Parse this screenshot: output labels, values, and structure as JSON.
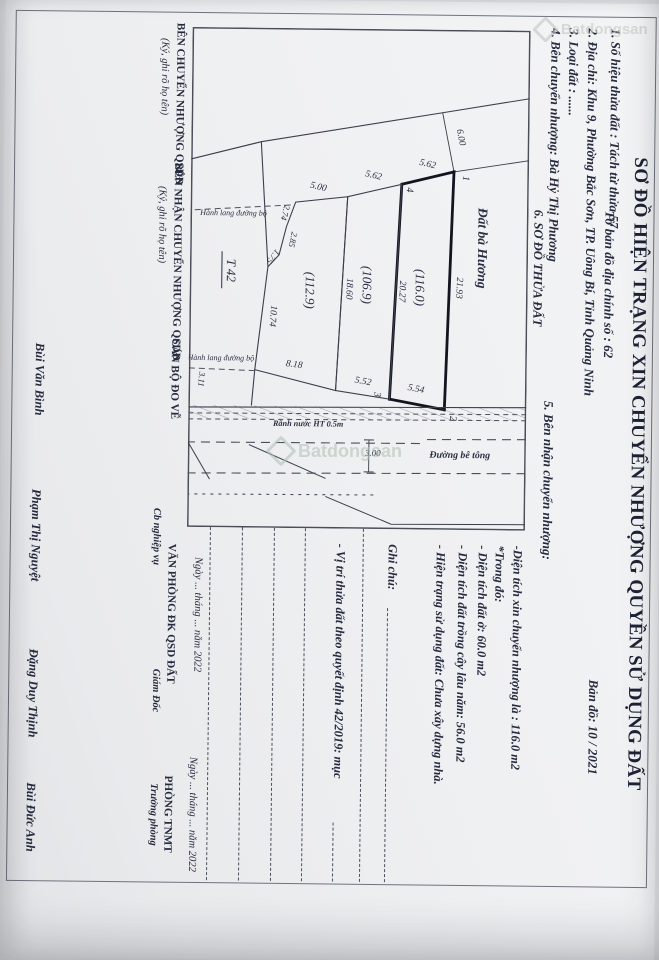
{
  "doc": {
    "title": "SƠ ĐỒ HIỆN TRẠNG XIN CHUYỂN NHƯỢNG QUYỀN SỬ DỤNG ĐẤT",
    "item1": "1. Số hiệu thửa đất : Tách từ thửa 57",
    "sheet": "Tờ bản đồ địa chính số : 62",
    "map_no": "Bản đồ:  10 / 2021",
    "item2": "2. Địa chỉ:  Khu 9, Phường Bắc Sơn, TP. Uông Bí, Tỉnh Quảng Ninh",
    "item3": "3. Loại đất  : ......",
    "item4": "4. Bên chuyển nhượng: Bà Hỷ Thị Phương",
    "item5": "5. Bên nhận chuyển nhượng:",
    "item6": "6. SƠ ĐỒ THỬA ĐẤT"
  },
  "map": {
    "neighbor": "Đất bà Hương",
    "tie_dim": "6.00",
    "v1": "1",
    "v2": "2",
    "v3": "3",
    "v4": "4",
    "p1": {
      "area": "(116.0)",
      "top": "21.93",
      "inner": "20.27",
      "left": "5.62",
      "right": "5.54"
    },
    "p2": {
      "area": "(106.9)",
      "inner": "18.60",
      "left": "5.62",
      "right": "5.52"
    },
    "p3": {
      "area": "(112.9)",
      "left": "5.00",
      "right": "8.18",
      "bottom": "10.74",
      "j1": "2.74",
      "j2": "2.85",
      "j3": "1.75",
      "extra": "3.11"
    },
    "marker": "T 42",
    "corridor": "Hành lang đường bộ",
    "ditch": "Rãnh nước HT 0.5m",
    "road": "Đường bê tông",
    "road_width": "3.00"
  },
  "notes": {
    "l1": "-Diện tích xin chuyển nhượng  là :  116.0  m2",
    "l2": "*Trong đó:",
    "l3": "- Diện tích đất ở: 60.0 m2",
    "l4": "- Diện tích đất trồng cây lâu năm: 56.0 m2",
    "l5": "- Hiện trạng sử dụng đất: Chưa xây dựng nhà.",
    "ghichu": "Ghi chú:",
    "vitri": "- Vị trí thửa đất theo quyết định 42/2019: mục"
  },
  "sign": {
    "c1_title": "BÊN CHUYỂN NHƯỢNG QSDĐ",
    "c1_sub": "(Ký, ghi rõ họ tên)",
    "c2_title": "BÊN NHẬN CHUYỂN NHƯỢNG QSDĐ",
    "c2_sub": "(Ký, ghi rõ họ tên)",
    "c3_title": "CÁN BỘ ĐO VẼ",
    "c3_name": "Bùi Văn Bình",
    "c4_date": "Ngày ... tháng ... năm 2022",
    "c4_title": "VĂN PHÒNG ĐK QSD ĐẤT",
    "c4_sub_left": "Cb nghiệp vụ",
    "c4_sub_right": "Giám Đốc",
    "c4_name_left": "Phạm Thị Nguyệt",
    "c4_name_right": "Đặng Duy Thịnh",
    "c5_date": "Ngày ... tháng ... năm 2022",
    "c5_title": "PHÒNG TNMT",
    "c5_sub": "Trưởng phòng",
    "c5_name": "Bùi Đức Anh"
  },
  "watermark": {
    "brand": "Batdongsan"
  }
}
